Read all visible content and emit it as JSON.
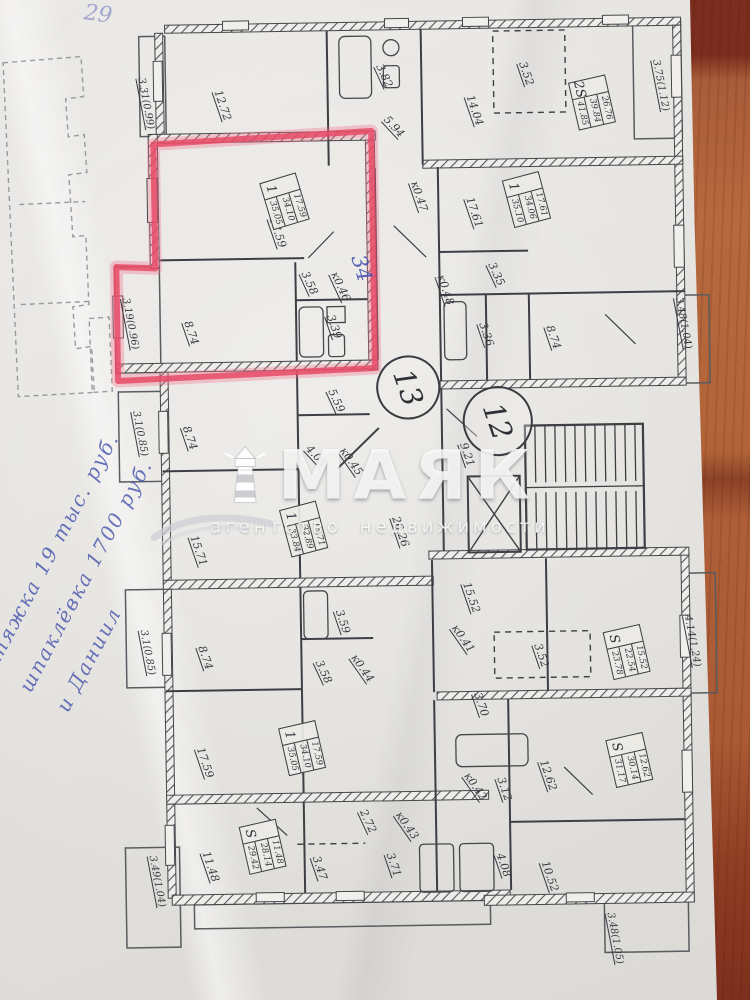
{
  "scene": {
    "table_color": "#b4653c",
    "paper_color": "#e3e1dd",
    "description": "photo of apartment floor plan on wooden table"
  },
  "watermark": {
    "brand": "МАЯК",
    "tagline": "агентство недвижимости",
    "icon": "lighthouse-icon"
  },
  "highlight": {
    "marker_color": "#e84a66"
  },
  "handwriting": {
    "ink_color": "#4553ad",
    "corner_mark": "29",
    "apartment_note": "34",
    "side_note_lines": [
      "стяжка  19 тыс. руб.",
      "шпаклёвка  1700 руб.",
      "и Даниил"
    ]
  },
  "plan": {
    "stamps": [
      {
        "text": "13",
        "x": 408,
        "y": 386,
        "r": 30,
        "rot": 72
      },
      {
        "text": "12",
        "x": 497,
        "y": 421,
        "r": 33,
        "rot": 72
      }
    ],
    "apartment_summaries": [
      {
        "type": "1",
        "values": [
          "17.59",
          "34.10",
          "35.05"
        ],
        "x": 289,
        "y": 200,
        "rot": 74
      },
      {
        "type": "2S",
        "values": [
          "26.76",
          "39.84",
          "41.85"
        ],
        "x": 598,
        "y": 106,
        "rot": 78
      },
      {
        "type": "1",
        "values": [
          "17.61",
          "34.06",
          "35.10"
        ],
        "x": 531,
        "y": 202,
        "rot": 76
      },
      {
        "type": "1",
        "values": [
          "15.71",
          "32.89",
          "33.84"
        ],
        "x": 303,
        "y": 528,
        "rot": 76
      },
      {
        "type": "1",
        "values": [
          "17.59",
          "34.10",
          "35.05"
        ],
        "x": 298,
        "y": 747,
        "rot": 78
      },
      {
        "type": "S",
        "values": [
          "15.52",
          "22.54",
          "23.78"
        ],
        "x": 624,
        "y": 656,
        "rot": 78
      },
      {
        "type": "S",
        "values": [
          "12.62",
          "30.14",
          "31.17"
        ],
        "x": 625,
        "y": 764,
        "rot": 78
      },
      {
        "type": "S",
        "values": [
          "11.48",
          "28.14",
          "29.42"
        ],
        "x": 257,
        "y": 845,
        "rot": 78
      }
    ],
    "room_labels": [
      {
        "text": "3.31(0.99)",
        "x": 152,
        "y": 100,
        "rot": 80,
        "fs": 10
      },
      {
        "text": "12.72",
        "x": 229,
        "y": 103,
        "rot": 72
      },
      {
        "text": "3.82",
        "x": 391,
        "y": 76,
        "rot": 66
      },
      {
        "text": "5.94",
        "x": 400,
        "y": 127,
        "rot": 48
      },
      {
        "text": "3.52",
        "x": 533,
        "y": 76,
        "rot": 72
      },
      {
        "text": "14.04",
        "x": 481,
        "y": 112,
        "rot": 72
      },
      {
        "text": "3.75(1.12)",
        "x": 667,
        "y": 90,
        "rot": 80,
        "fs": 10
      },
      {
        "text": "17.59",
        "x": 282,
        "y": 231,
        "rot": 72
      },
      {
        "text": "к0.47",
        "x": 424,
        "y": 197,
        "rot": 72
      },
      {
        "text": "17.61",
        "x": 479,
        "y": 214,
        "rot": 72
      },
      {
        "text": "3.35",
        "x": 500,
        "y": 276,
        "rot": 66
      },
      {
        "text": "к0.48",
        "x": 449,
        "y": 291,
        "rot": 72
      },
      {
        "text": "3.58",
        "x": 313,
        "y": 282,
        "rot": 66
      },
      {
        "text": "к0.46",
        "x": 344,
        "y": 286,
        "rot": 66
      },
      {
        "text": "3.39",
        "x": 337,
        "y": 326,
        "rot": 72
      },
      {
        "text": "8.74",
        "x": 194,
        "y": 330,
        "rot": 72
      },
      {
        "text": "3.19(0.96)",
        "x": 133,
        "y": 320,
        "rot": 80,
        "fs": 10
      },
      {
        "text": "3.36",
        "x": 489,
        "y": 336,
        "rot": 72
      },
      {
        "text": "8.74",
        "x": 556,
        "y": 340,
        "rot": 72
      },
      {
        "text": "3.48(1.04)",
        "x": 686,
        "y": 328,
        "rot": 80,
        "fs": 10
      },
      {
        "text": "3.1(0.85)",
        "x": 141,
        "y": 430,
        "rot": 80,
        "fs": 10
      },
      {
        "text": "8.74",
        "x": 191,
        "y": 435,
        "rot": 72
      },
      {
        "text": "5.59",
        "x": 338,
        "y": 400,
        "rot": 66
      },
      {
        "text": "4.05",
        "x": 317,
        "y": 455,
        "rot": 48
      },
      {
        "text": "к0.45",
        "x": 352,
        "y": 461,
        "rot": 56
      },
      {
        "text": "9.21",
        "x": 468,
        "y": 456,
        "rot": 72
      },
      {
        "text": "26.26",
        "x": 400,
        "y": 532,
        "rot": 72
      },
      {
        "text": "15.71",
        "x": 198,
        "y": 548,
        "rot": 72
      },
      {
        "text": "15.52",
        "x": 470,
        "y": 599,
        "rot": 72
      },
      {
        "text": "к0.41",
        "x": 461,
        "y": 640,
        "rot": 56
      },
      {
        "text": "3.52",
        "x": 539,
        "y": 658,
        "rot": 72
      },
      {
        "text": "3.1(0.85)",
        "x": 145,
        "y": 649,
        "rot": 80,
        "fs": 10
      },
      {
        "text": "3.59",
        "x": 341,
        "y": 621,
        "rot": 72
      },
      {
        "text": "8.74",
        "x": 203,
        "y": 655,
        "rot": 72
      },
      {
        "text": "3.58",
        "x": 321,
        "y": 671,
        "rot": 66
      },
      {
        "text": "к0.44",
        "x": 360,
        "y": 668,
        "rot": 56
      },
      {
        "text": "3.70",
        "x": 478,
        "y": 706,
        "rot": 72
      },
      {
        "text": "4.14(1.24)",
        "x": 690,
        "y": 646,
        "rot": 80,
        "fs": 10
      },
      {
        "text": "17.59",
        "x": 201,
        "y": 760,
        "rot": 72
      },
      {
        "text": "12.62",
        "x": 544,
        "y": 778,
        "rot": 72
      },
      {
        "text": "3.12",
        "x": 500,
        "y": 791,
        "rot": 72
      },
      {
        "text": "к0.42",
        "x": 471,
        "y": 788,
        "rot": 56
      },
      {
        "text": "2.72",
        "x": 363,
        "y": 821,
        "rot": 66
      },
      {
        "text": "к0.43",
        "x": 402,
        "y": 826,
        "rot": 56
      },
      {
        "text": "11.48",
        "x": 205,
        "y": 864,
        "rot": 72
      },
      {
        "text": "3.47",
        "x": 314,
        "y": 867,
        "rot": 72
      },
      {
        "text": "3.71",
        "x": 388,
        "y": 865,
        "rot": 72
      },
      {
        "text": "4.08",
        "x": 498,
        "y": 867,
        "rot": 72
      },
      {
        "text": "10.52",
        "x": 544,
        "y": 879,
        "rot": 72
      },
      {
        "text": "3.49(1.04)",
        "x": 151,
        "y": 878,
        "rot": 80,
        "fs": 10
      },
      {
        "text": "3.48(1.05)",
        "x": 608,
        "y": 942,
        "rot": 80,
        "fs": 10
      }
    ]
  }
}
